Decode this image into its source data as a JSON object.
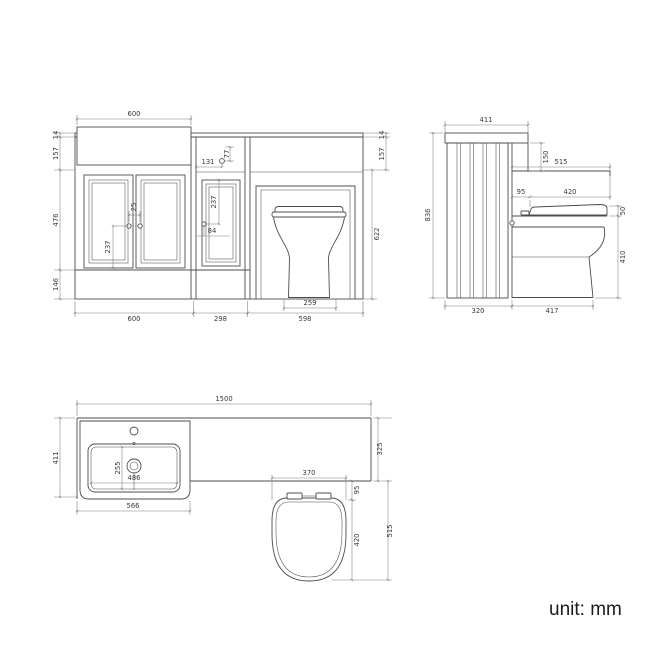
{
  "page": {
    "unit_label": "unit: mm"
  },
  "front_view": {
    "dims": {
      "basin_top_width": "600",
      "worktop_thickness": "14",
      "apron_height": "157",
      "door_height": "476",
      "plinth_height": "146",
      "right_worktop_thickness": "14",
      "right_apron_height": "157",
      "carcass_height": "622",
      "vanity_width": "600",
      "link_unit_width": "298",
      "wc_unit_width": "598",
      "handle_spacing": "25",
      "handle_to_door_bottom": "237",
      "button_offset_horizontal": "131",
      "button_offset_vertical": "77",
      "mid_door_top_to_handle": "237",
      "mid_handle_offset": "84",
      "pan_base_width": "259"
    }
  },
  "side_view": {
    "dims": {
      "cabinet_top_depth": "411",
      "worktop_recess_height": "150",
      "overall_height": "836",
      "worktop_depth": "515",
      "seat_back_gap": "95",
      "seat_length": "420",
      "seat_thickness": "50",
      "pan_height": "410",
      "cabinet_depth": "320",
      "pan_projection": "417"
    }
  },
  "plan_view": {
    "dims": {
      "overall_width": "1500",
      "vanity_depth": "411",
      "worktop_depth": "325",
      "basin_unit_width": "566",
      "basin_bowl_width": "486",
      "basin_bowl_depth": "255",
      "seat_width": "370",
      "seat_back_gap": "95",
      "seat_length": "420",
      "wc_projection": "515"
    }
  }
}
